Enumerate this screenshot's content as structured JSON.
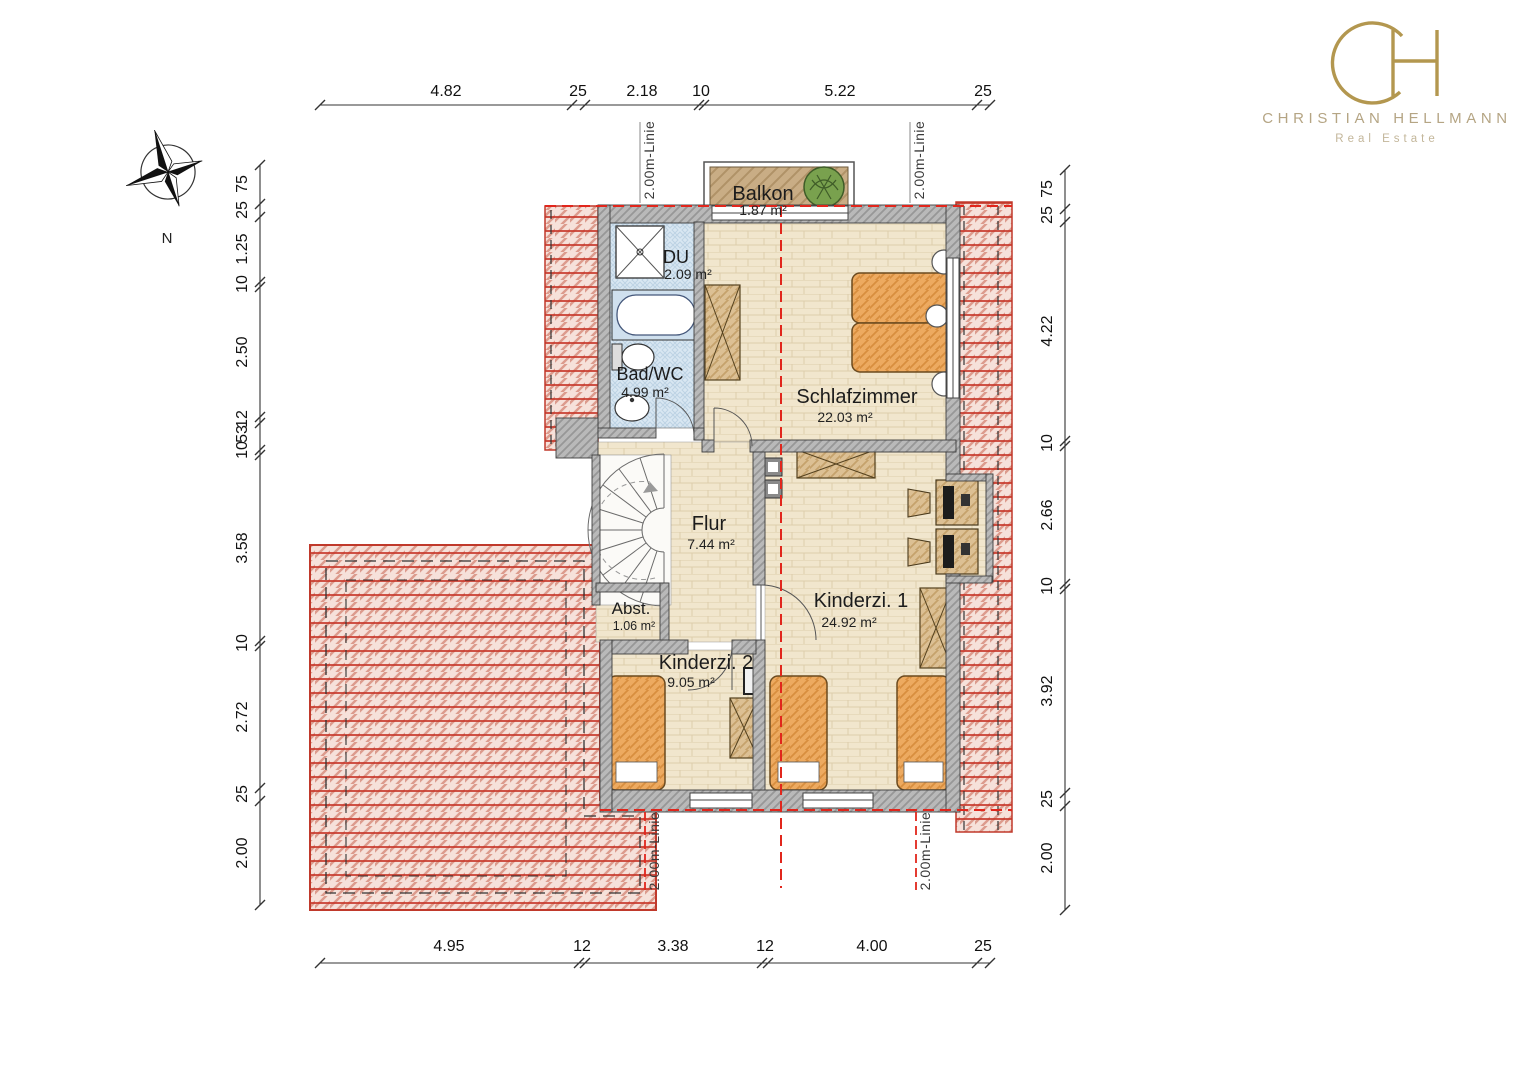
{
  "logo": {
    "monogram": "CH",
    "name": "CHRISTIAN HELLMANN",
    "tagline": "Real Estate",
    "gold": "#b3974f"
  },
  "compass": {
    "north": "N"
  },
  "rooms": {
    "balkon": {
      "name": "Balkon",
      "area": "1.87 m²"
    },
    "du": {
      "name": "DU",
      "area": "2.09 m²"
    },
    "bad_wc": {
      "name": "Bad/WC",
      "area": "4.99 m²"
    },
    "schlafzimmer": {
      "name": "Schlafzimmer",
      "area": "22.03 m²"
    },
    "flur": {
      "name": "Flur",
      "area": "7.44 m²"
    },
    "abstellraum": {
      "name": "Abst.",
      "area": "1.06 m²"
    },
    "kinderzimmer1": {
      "name": "Kinderzi. 1",
      "area": "24.92 m²"
    },
    "kinderzimmer2": {
      "name": "Kinderzi. 2",
      "area": "9.05 m²"
    }
  },
  "annotations": {
    "height_line": "2.00m-Linie"
  },
  "dims": {
    "top": [
      "4.82",
      "25",
      "2.18",
      "10",
      "5.22",
      "25"
    ],
    "bottom": [
      "4.95",
      "12",
      "3.38",
      "12",
      "4.00",
      "25"
    ],
    "left": [
      "75",
      "25",
      "1.25",
      "10",
      "2.50",
      "12",
      "53",
      "10",
      "3.58",
      "10",
      "2.72",
      "25",
      "2.00"
    ],
    "right": [
      "75",
      "25",
      "4.22",
      "10",
      "2.66",
      "10",
      "3.92",
      "25",
      "2.00"
    ]
  },
  "colors": {
    "roof_red": "#c0392b",
    "dashed_red": "#e1261c",
    "wall_gray": "#b5b5b5",
    "floor_beige": "#f1e6cd",
    "bath_blue": "#d9e7f2",
    "furniture_orange": "#edaa60",
    "wood_tan": "#dcc094"
  }
}
